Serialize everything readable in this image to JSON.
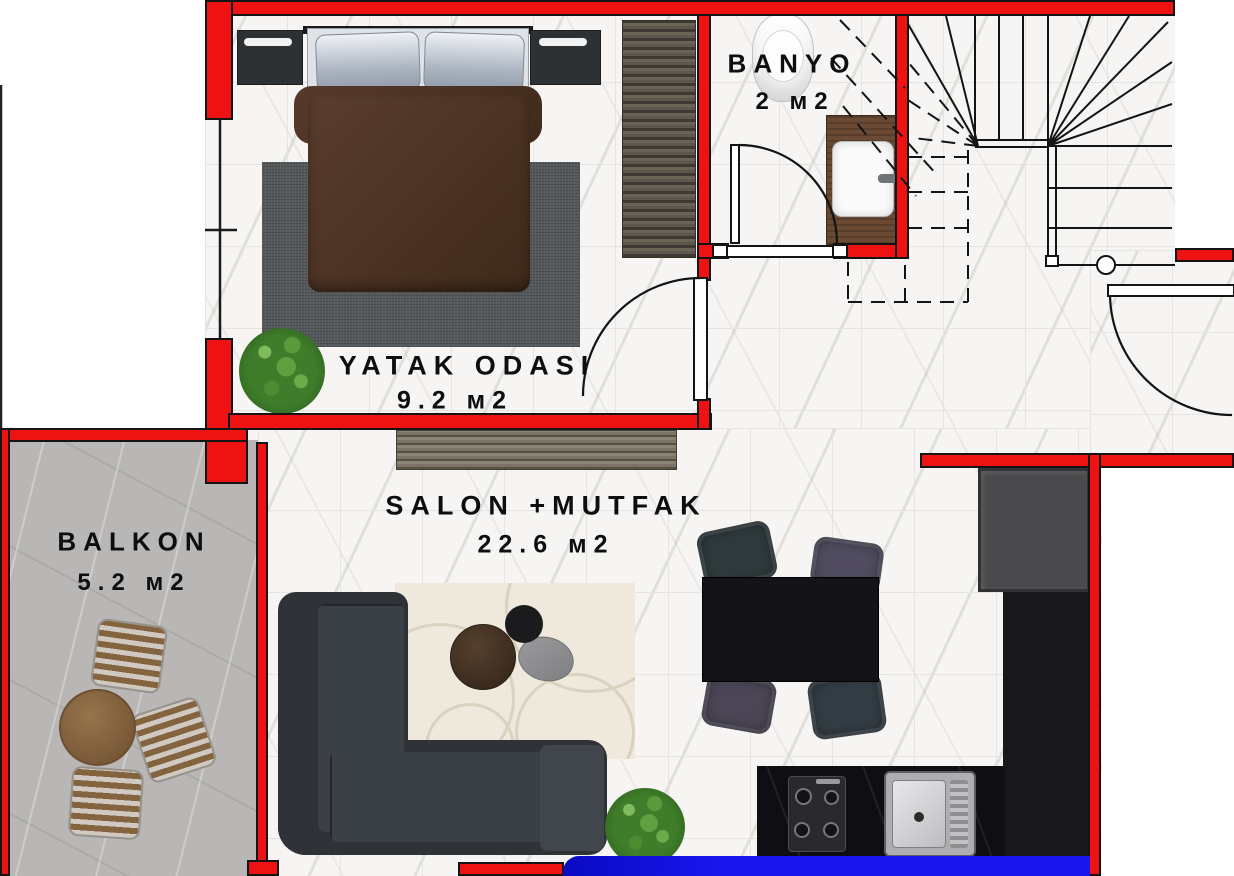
{
  "rooms": {
    "banyo": {
      "label": "BANYO",
      "area": "2 м2"
    },
    "yatak": {
      "label": "YATAK ODASI",
      "area": "9.2 м2"
    },
    "salon": {
      "label": "SALON +MUTFAK",
      "area": "22.6 м2"
    },
    "balkon": {
      "label": "BALKON",
      "area": "5.2 м2"
    }
  },
  "colors": {
    "wall_red": "#ee1212",
    "window_glass_blue": "#1a15ee",
    "floor_marble": "#f6f5f3",
    "balcony_stone": "#b9b7b5",
    "line_black": "#141414"
  }
}
